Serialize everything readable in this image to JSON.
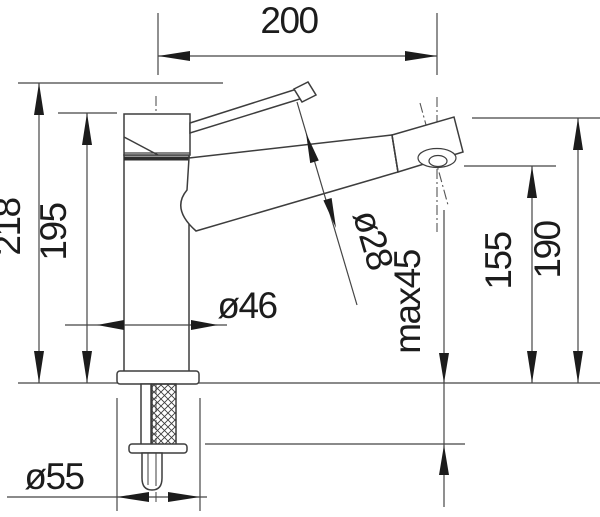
{
  "title": "Kitchen faucet dimension drawing",
  "colors": {
    "background": "#ffffff",
    "object_line": "#3d3d3d",
    "dimension_line": "#454545",
    "arrow_and_text": "#1c1c1c"
  },
  "dimensions": {
    "spout_reach": {
      "label": "200",
      "meaning": "horizontal distance body axis to aerator axis"
    },
    "total_height": {
      "label": "218",
      "meaning": "overall height above deck"
    },
    "body_height": {
      "label": "195",
      "meaning": "height of body top above deck"
    },
    "body_diameter": {
      "label": "ø46",
      "meaning": "body diameter"
    },
    "spout_diameter": {
      "label": "ø28",
      "meaning": "spout tube diameter"
    },
    "max_deck_thickness": {
      "label": "max45",
      "meaning": "maximum countertop thickness"
    },
    "aerator_height": {
      "label": "155",
      "meaning": "aerator outlet height above deck"
    },
    "spout_height": {
      "label": "190",
      "meaning": "spout end top height above deck"
    },
    "base_diameter": {
      "label": "ø55",
      "meaning": "base flange diameter"
    }
  }
}
